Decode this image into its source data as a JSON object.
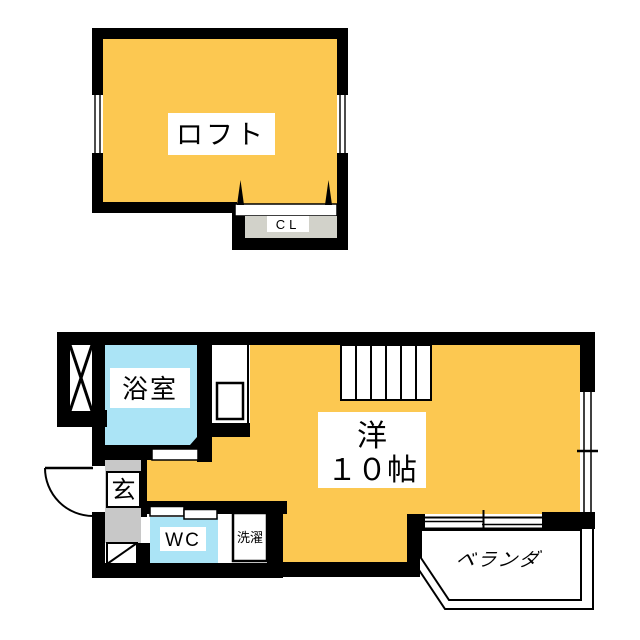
{
  "loft_plan": {
    "room_label": "ロフト",
    "closet_label": "CL"
  },
  "main_plan": {
    "bathroom_label": "浴室",
    "entrance_label": "玄",
    "toilet_label": "WC",
    "laundry_label": "洗濯",
    "room_label_line1": "洋",
    "room_label_line2": "１０帖",
    "balcony_label": "ベランダ"
  },
  "colors": {
    "room_fill": "#FCC851",
    "wet_area_fill": "#ABE4F6",
    "entrance_fill": "#C8C8C8",
    "closet_fill": "#D2D2CA",
    "wall": "#000000",
    "background": "#FFFFFF"
  }
}
